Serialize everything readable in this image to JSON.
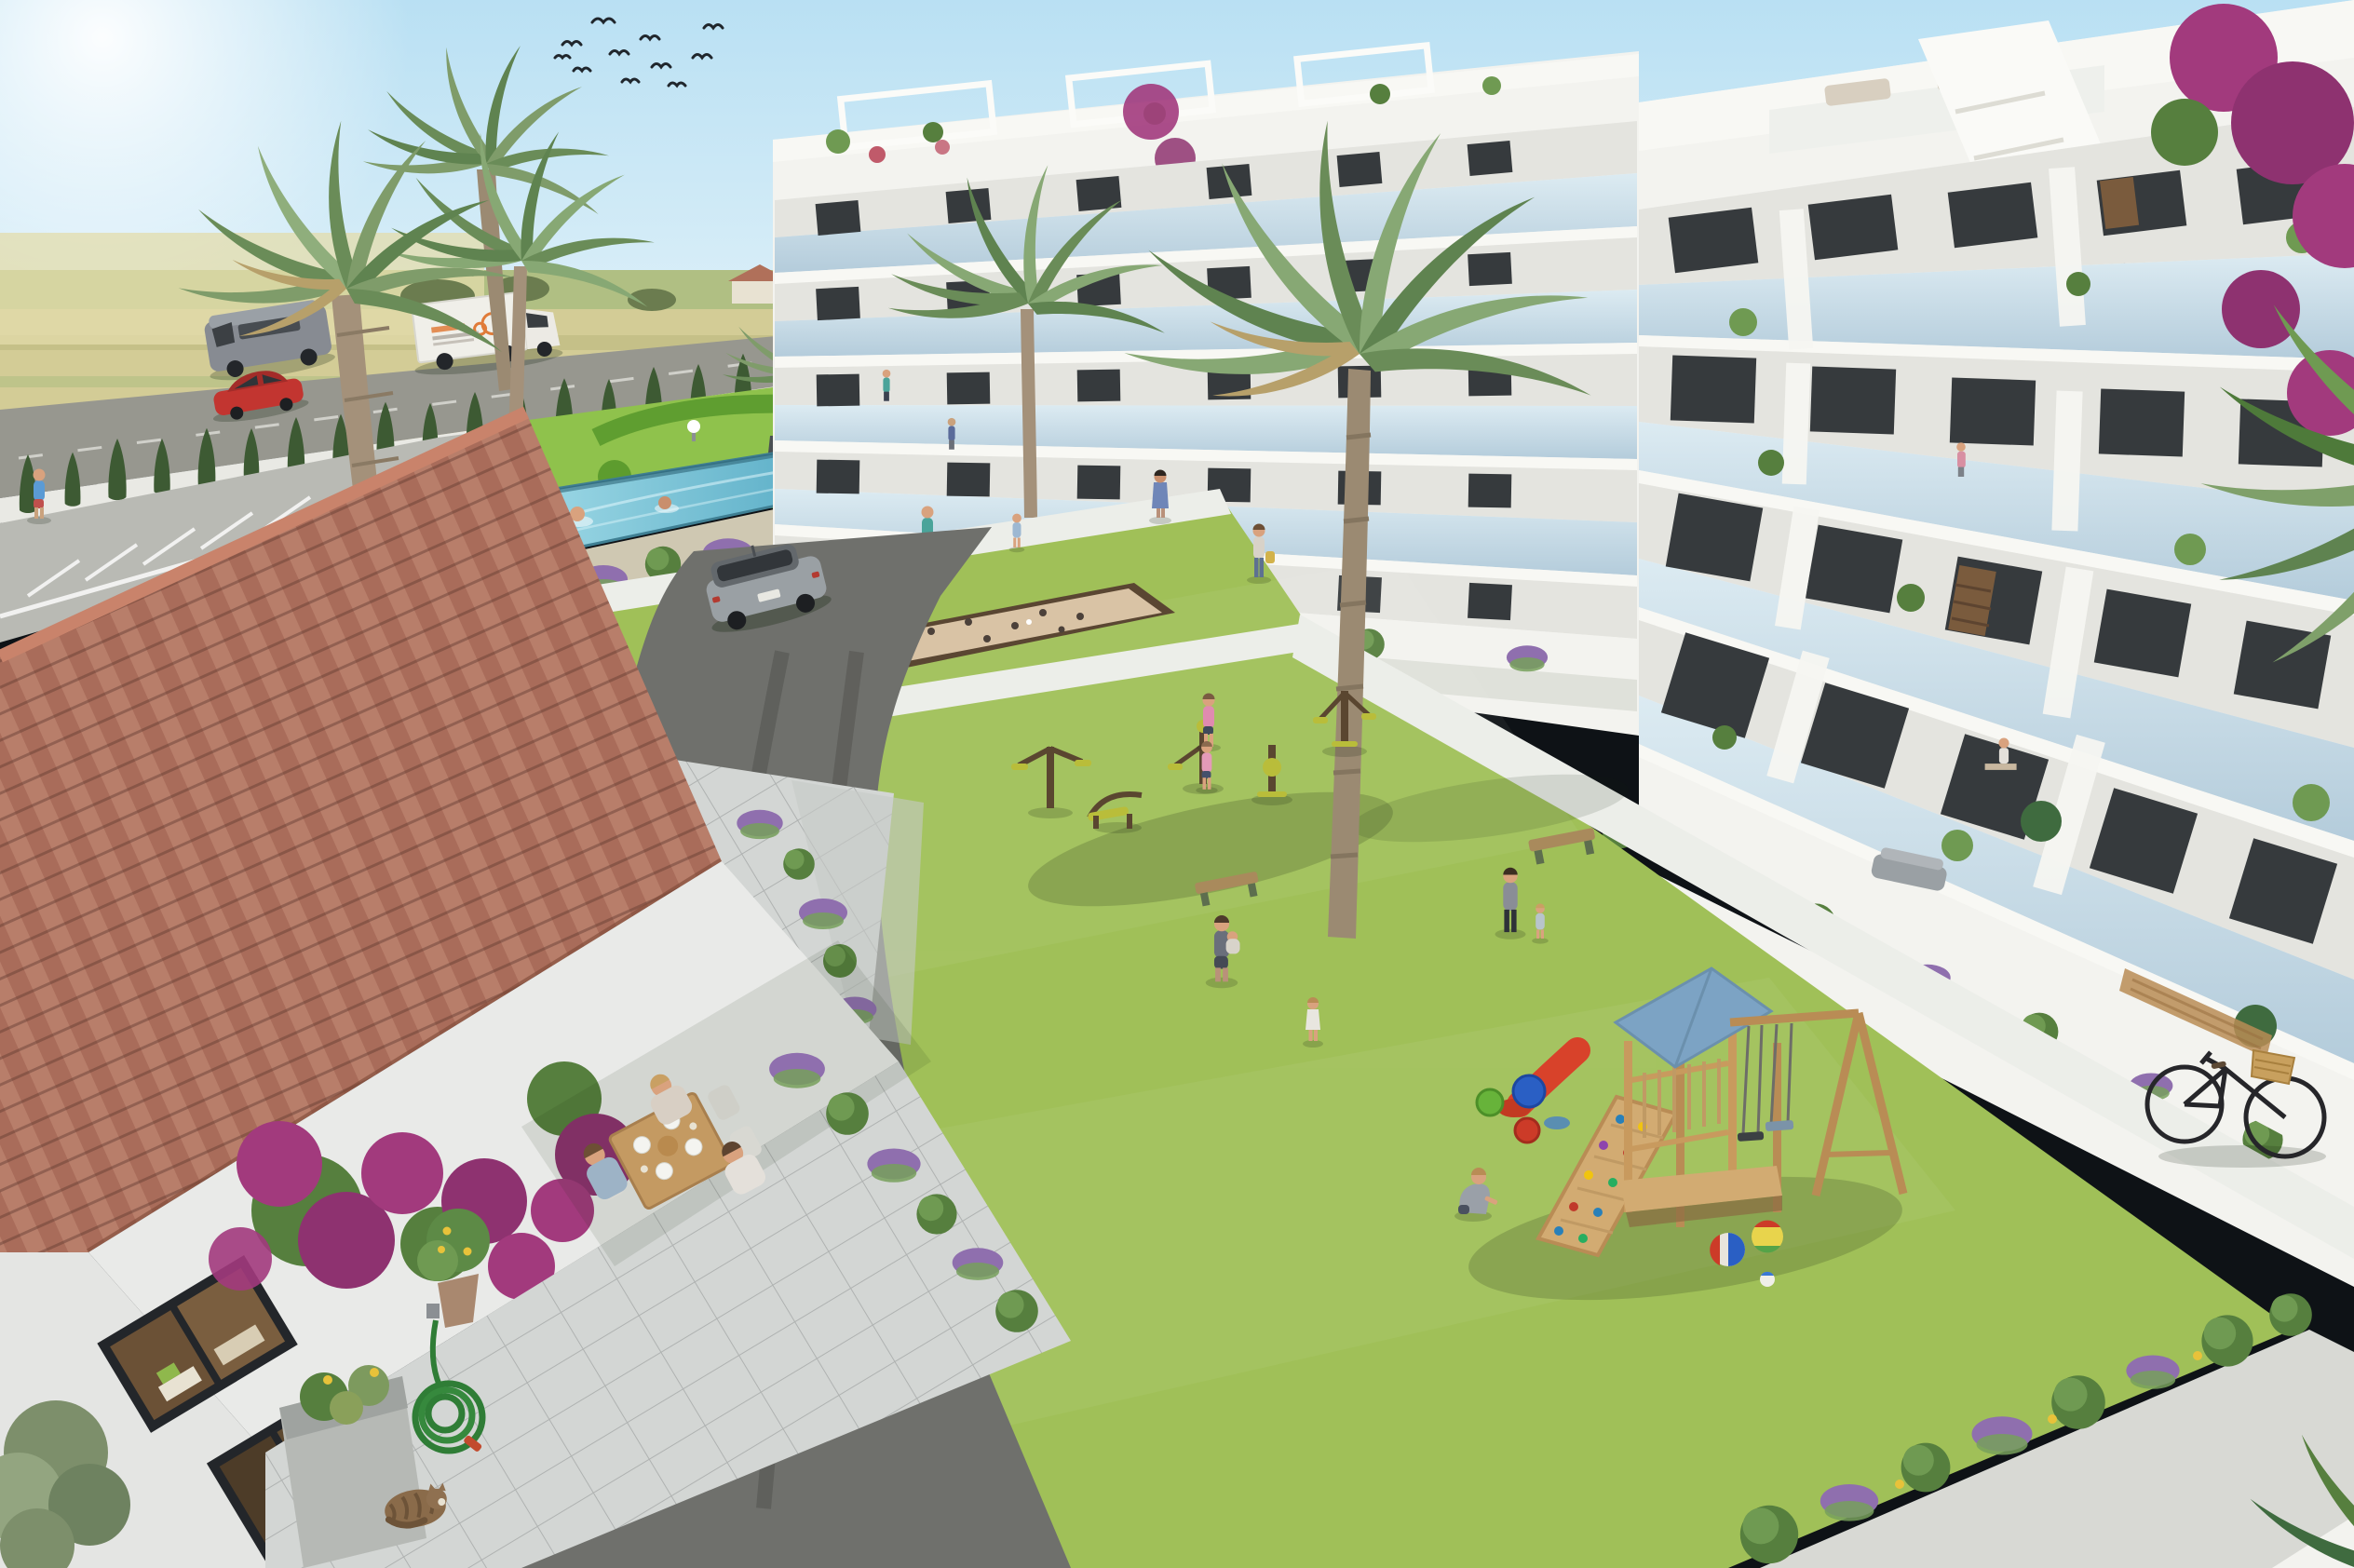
{
  "scene": {
    "label": "Aerial 3D architectural rendering of a Mediterranean residential complex: white apartment blocks with glass balconies around a green courtyard with pool, playground, outdoor gym and petanque court, next to a traditional tiled-roof farmhouse, country road and fields",
    "elements": [
      "sky",
      "sun-glare",
      "bird-flock",
      "farm-fields",
      "farmhouse-horizon",
      "country-road",
      "grey-van",
      "delivery-truck-orange-logo",
      "red-car",
      "cypress-hedge",
      "parking-bays",
      "palm-trees",
      "parterre-garden",
      "garden-lamps",
      "swimming-pool",
      "swimmers",
      "center-apartment-block",
      "right-apartment-block",
      "glass-balconies",
      "rooftop-pergolas",
      "bougainvillea",
      "courtyard-lawn",
      "white-paths",
      "petanque-court",
      "outdoor-gym-equipment",
      "park-benches",
      "playground-tower",
      "blue-play-roof",
      "climbing-ramp",
      "red-slide",
      "swing-set",
      "toy-buckets",
      "play-balls",
      "residents-people",
      "spanish-farmhouse",
      "terracotta-tiled-roof",
      "dining-terrace-people",
      "garden-statue",
      "potted-olive-tree",
      "potted-agave",
      "lemon-tree-pot",
      "planter-trough",
      "coiled-garden-hose",
      "sleeping-cat",
      "asphalt-driveway",
      "parked-silver-suv",
      "city-bicycle-basket",
      "shrub-lavender-border"
    ],
    "people_count": 20,
    "weather": "sunny clear day"
  },
  "palette": {
    "sky_top": "#b9e0f3",
    "sky_horizon": "#edf7fb",
    "sun": "#ffffff",
    "field": "#d3cc96",
    "field_green": "#a8bc7e",
    "road": "#97978f",
    "cypress": "#3d5a33",
    "garden_grass": "#8fc24c",
    "lawn": "#a0c058",
    "path": "#eceee9",
    "pool_light": "#9ed9e6",
    "pool_deep": "#4aa3bf",
    "building_white": "#f3f3ef",
    "glass": "#c9dce8",
    "window": "#363a3d",
    "roof_tile": "#b0705a",
    "roof_tile_dark": "#a05c48",
    "bougainvillea": "#a23a7d",
    "lavender": "#8f6fae",
    "asphalt": "#6f706c",
    "wood": "#c89a5e",
    "play_roof": "#7ca3c4",
    "sand": "#d9c3a5",
    "gym_yellow": "#b9bd3a",
    "truck_logo": "#e07b39",
    "car_red": "#c23530",
    "suv_silver": "#9aa0a4",
    "cat_brown": "#8a6b4a",
    "hose_green": "#2f7d36"
  }
}
